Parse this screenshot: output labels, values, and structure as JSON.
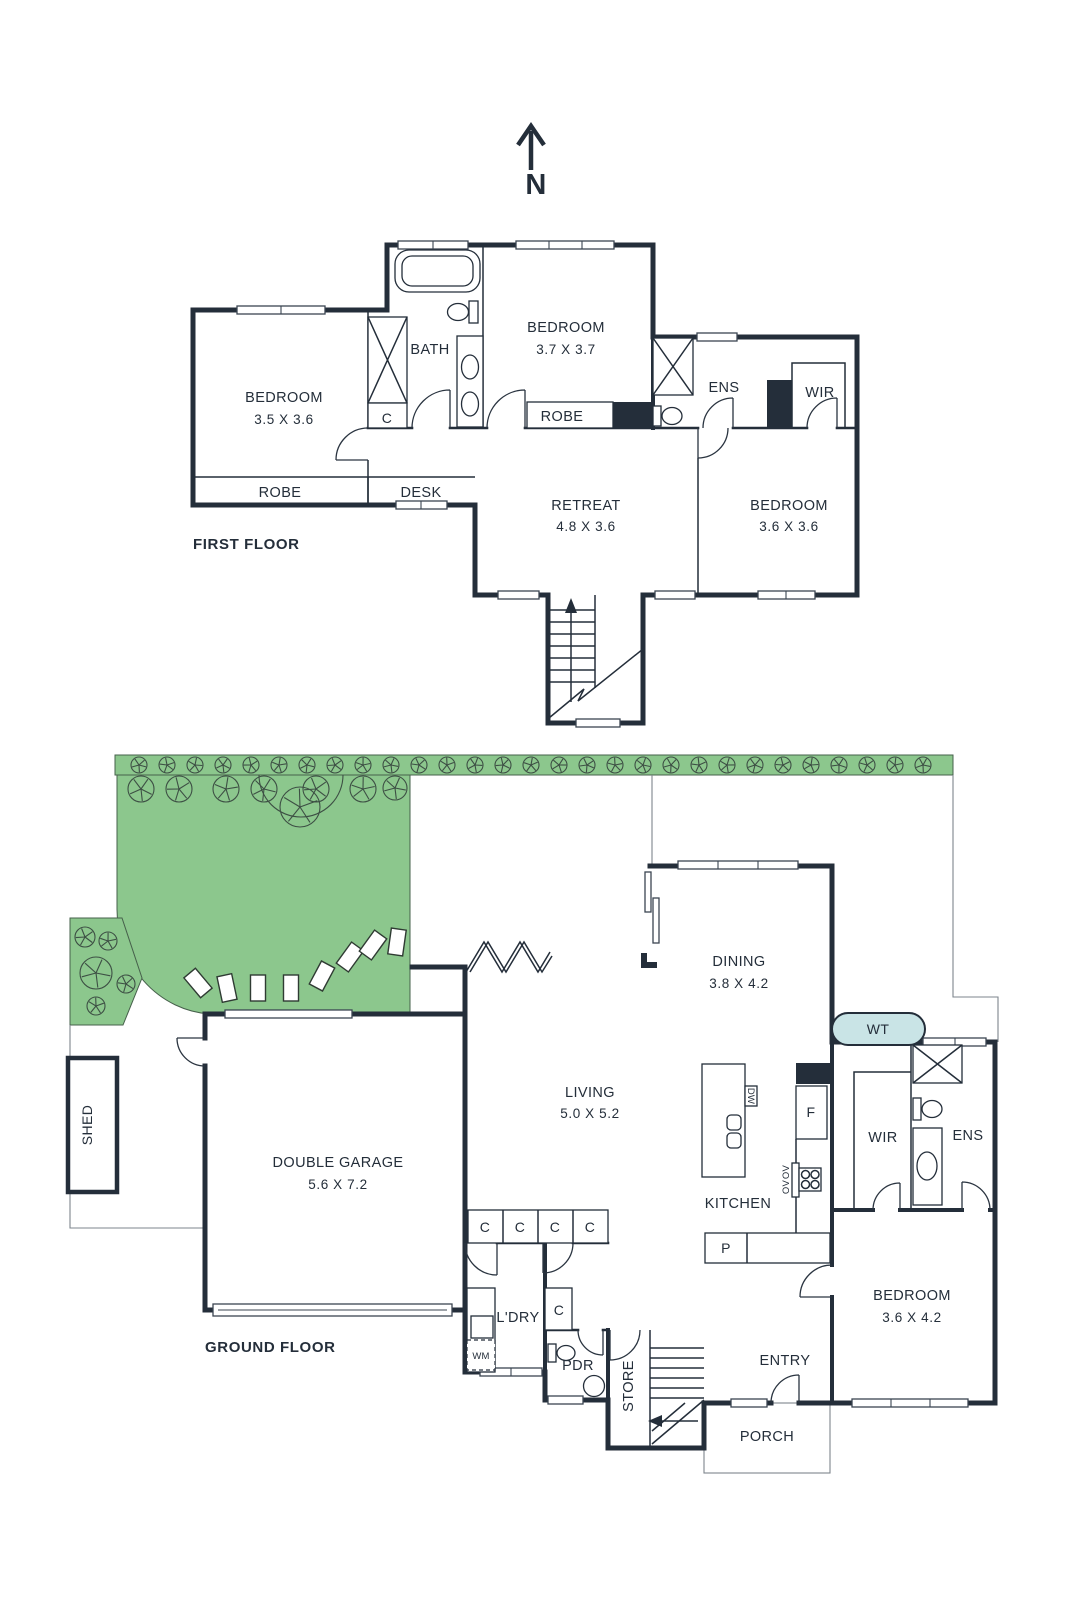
{
  "colors": {
    "wall": "#242e3a",
    "garden_green": "#8cc78d",
    "water_tank_blue": "#c9e4e6",
    "background": "#ffffff"
  },
  "north": {
    "label": "N"
  },
  "first_floor": {
    "title": "FIRST FLOOR",
    "bedroom1": {
      "name": "BEDROOM",
      "dims": "3.5 X 3.6"
    },
    "bath": "BATH",
    "cupboard": "C",
    "bedroom2": {
      "name": "BEDROOM",
      "dims": "3.7 X 3.7"
    },
    "robe1": "ROBE",
    "desk": "DESK",
    "robe2": "ROBE",
    "ens": "ENS",
    "wir": "WIR",
    "retreat": {
      "name": "RETREAT",
      "dims": "4.8 X 3.6"
    },
    "bedroom3": {
      "name": "BEDROOM",
      "dims": "3.6 X 3.6"
    }
  },
  "ground_floor": {
    "title": "GROUND FLOOR",
    "shed": "SHED",
    "garage": {
      "name": "DOUBLE GARAGE",
      "dims": "5.6 X 7.2"
    },
    "living": {
      "name": "LIVING",
      "dims": "5.0 X 5.2"
    },
    "dining": {
      "name": "DINING",
      "dims": "3.8 X 4.2"
    },
    "water_tank": "WT",
    "kitchen": "KITCHEN",
    "fridge": "F",
    "dishwasher": "DW",
    "oven1": "OV",
    "oven2": "OV",
    "pantry": "P",
    "cupboards": [
      "C",
      "C",
      "C",
      "C"
    ],
    "laundry": "L'DRY",
    "washing_machine": "WM",
    "cupboard_hall": "C",
    "powder": "PDR",
    "store": "STORE",
    "entry": "ENTRY",
    "porch": "PORCH",
    "bedroom4": {
      "name": "BEDROOM",
      "dims": "3.6 X 4.2"
    },
    "wir": "WIR",
    "ens": "ENS"
  }
}
